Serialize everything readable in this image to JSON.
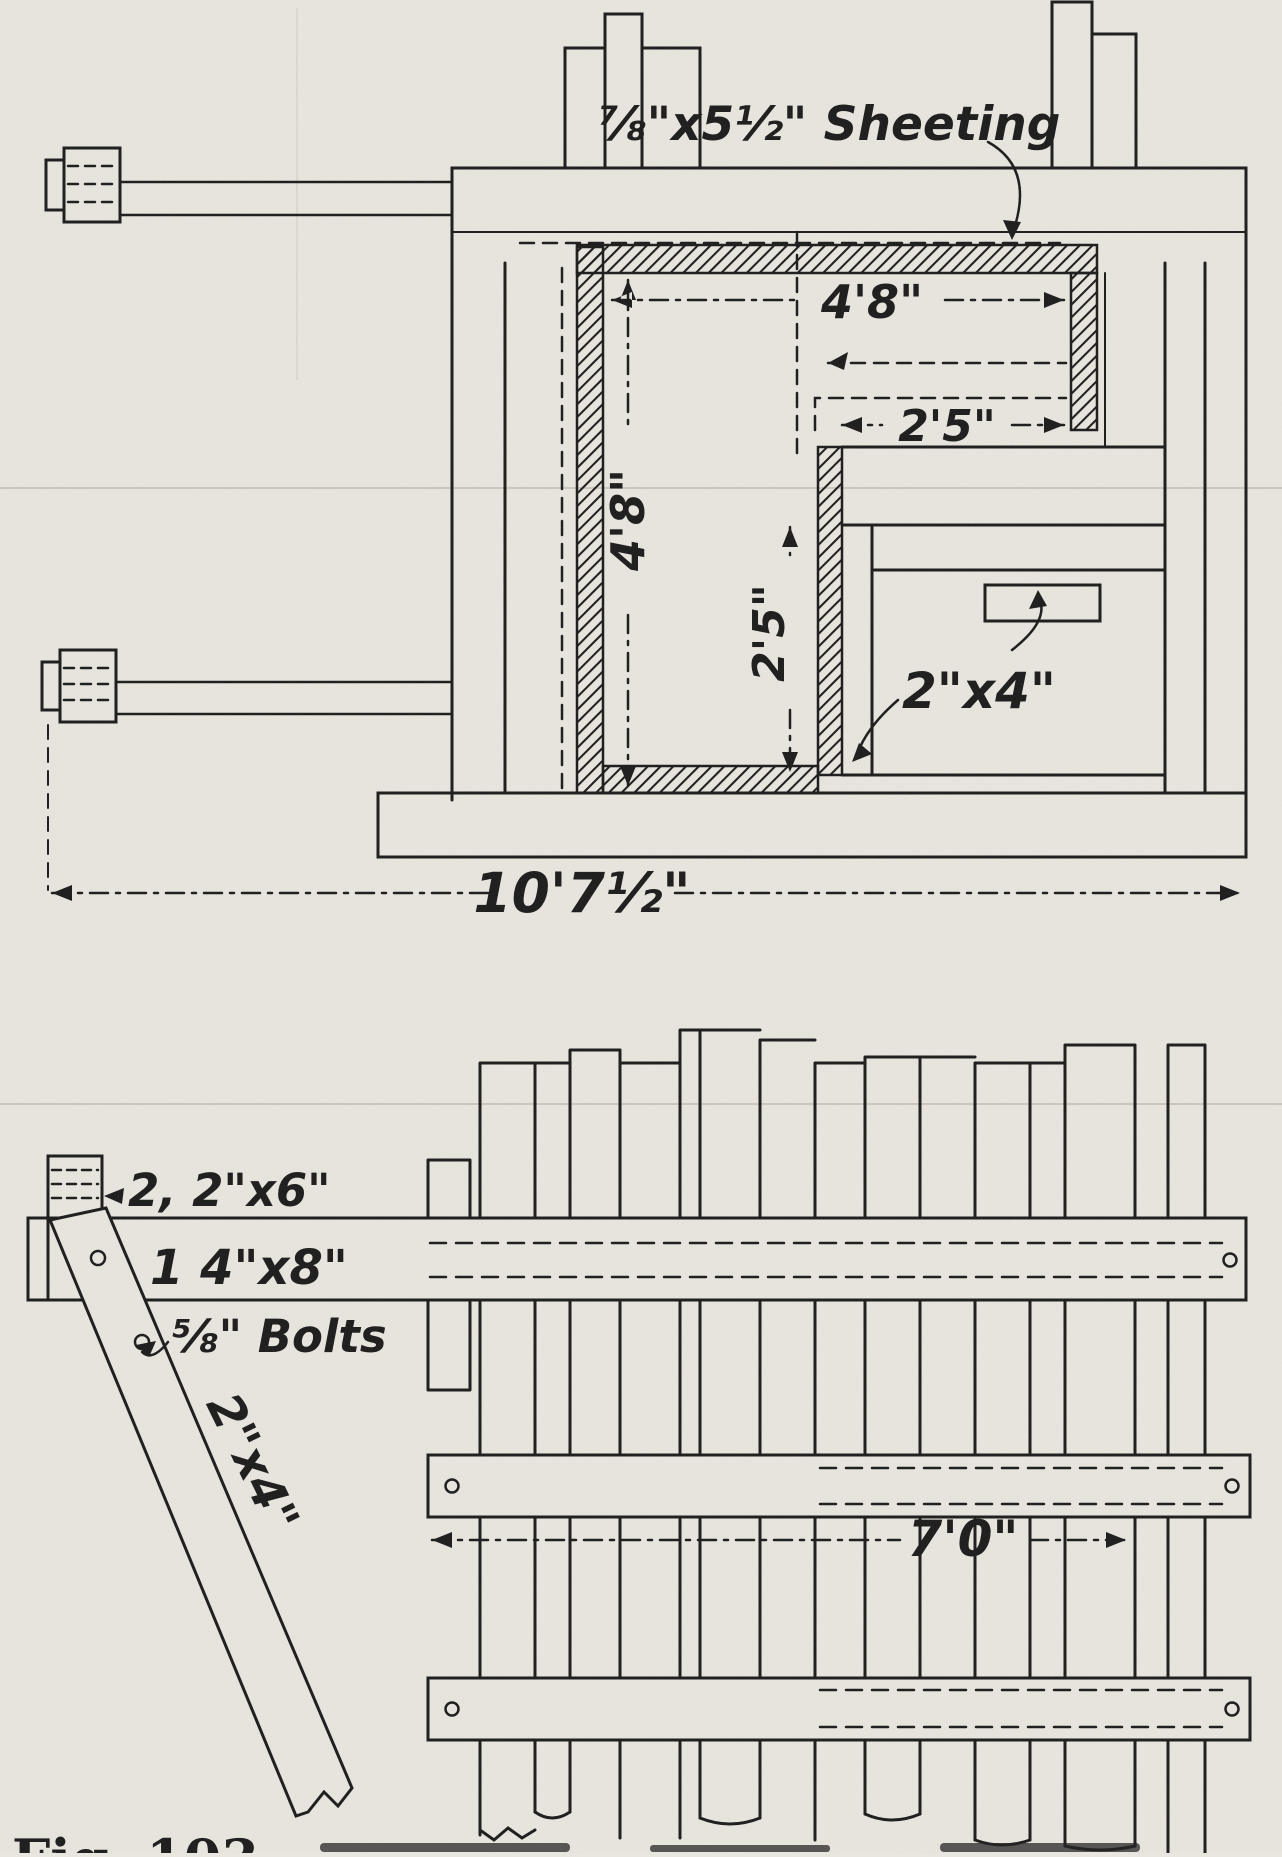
{
  "page": {
    "paper_color": "#e9e6df",
    "ink_color": "#1b1b1b",
    "caption_fragment": "Fig. 103."
  },
  "plan_view": {
    "title": "plan-view-of-wall-form",
    "labels": {
      "sheeting": "⅞\"x5½\" Sheeting",
      "ledger": "2\"x4\""
    },
    "dimensions": {
      "inner_width": "4'8\"",
      "step_width": "2'5\"",
      "inner_height": "4'8\"",
      "step_height": "2'5\"",
      "overall_width": "10'7½\""
    }
  },
  "elevation_view": {
    "title": "side-elevation-of-wall-form",
    "labels": {
      "plates": "2, 2\"x6\"",
      "wale": "1 4\"x8\"",
      "bolts": "⅝\" Bolts",
      "brace": "2\"x4\""
    },
    "dimensions": {
      "panel_width": "7'0\""
    }
  }
}
